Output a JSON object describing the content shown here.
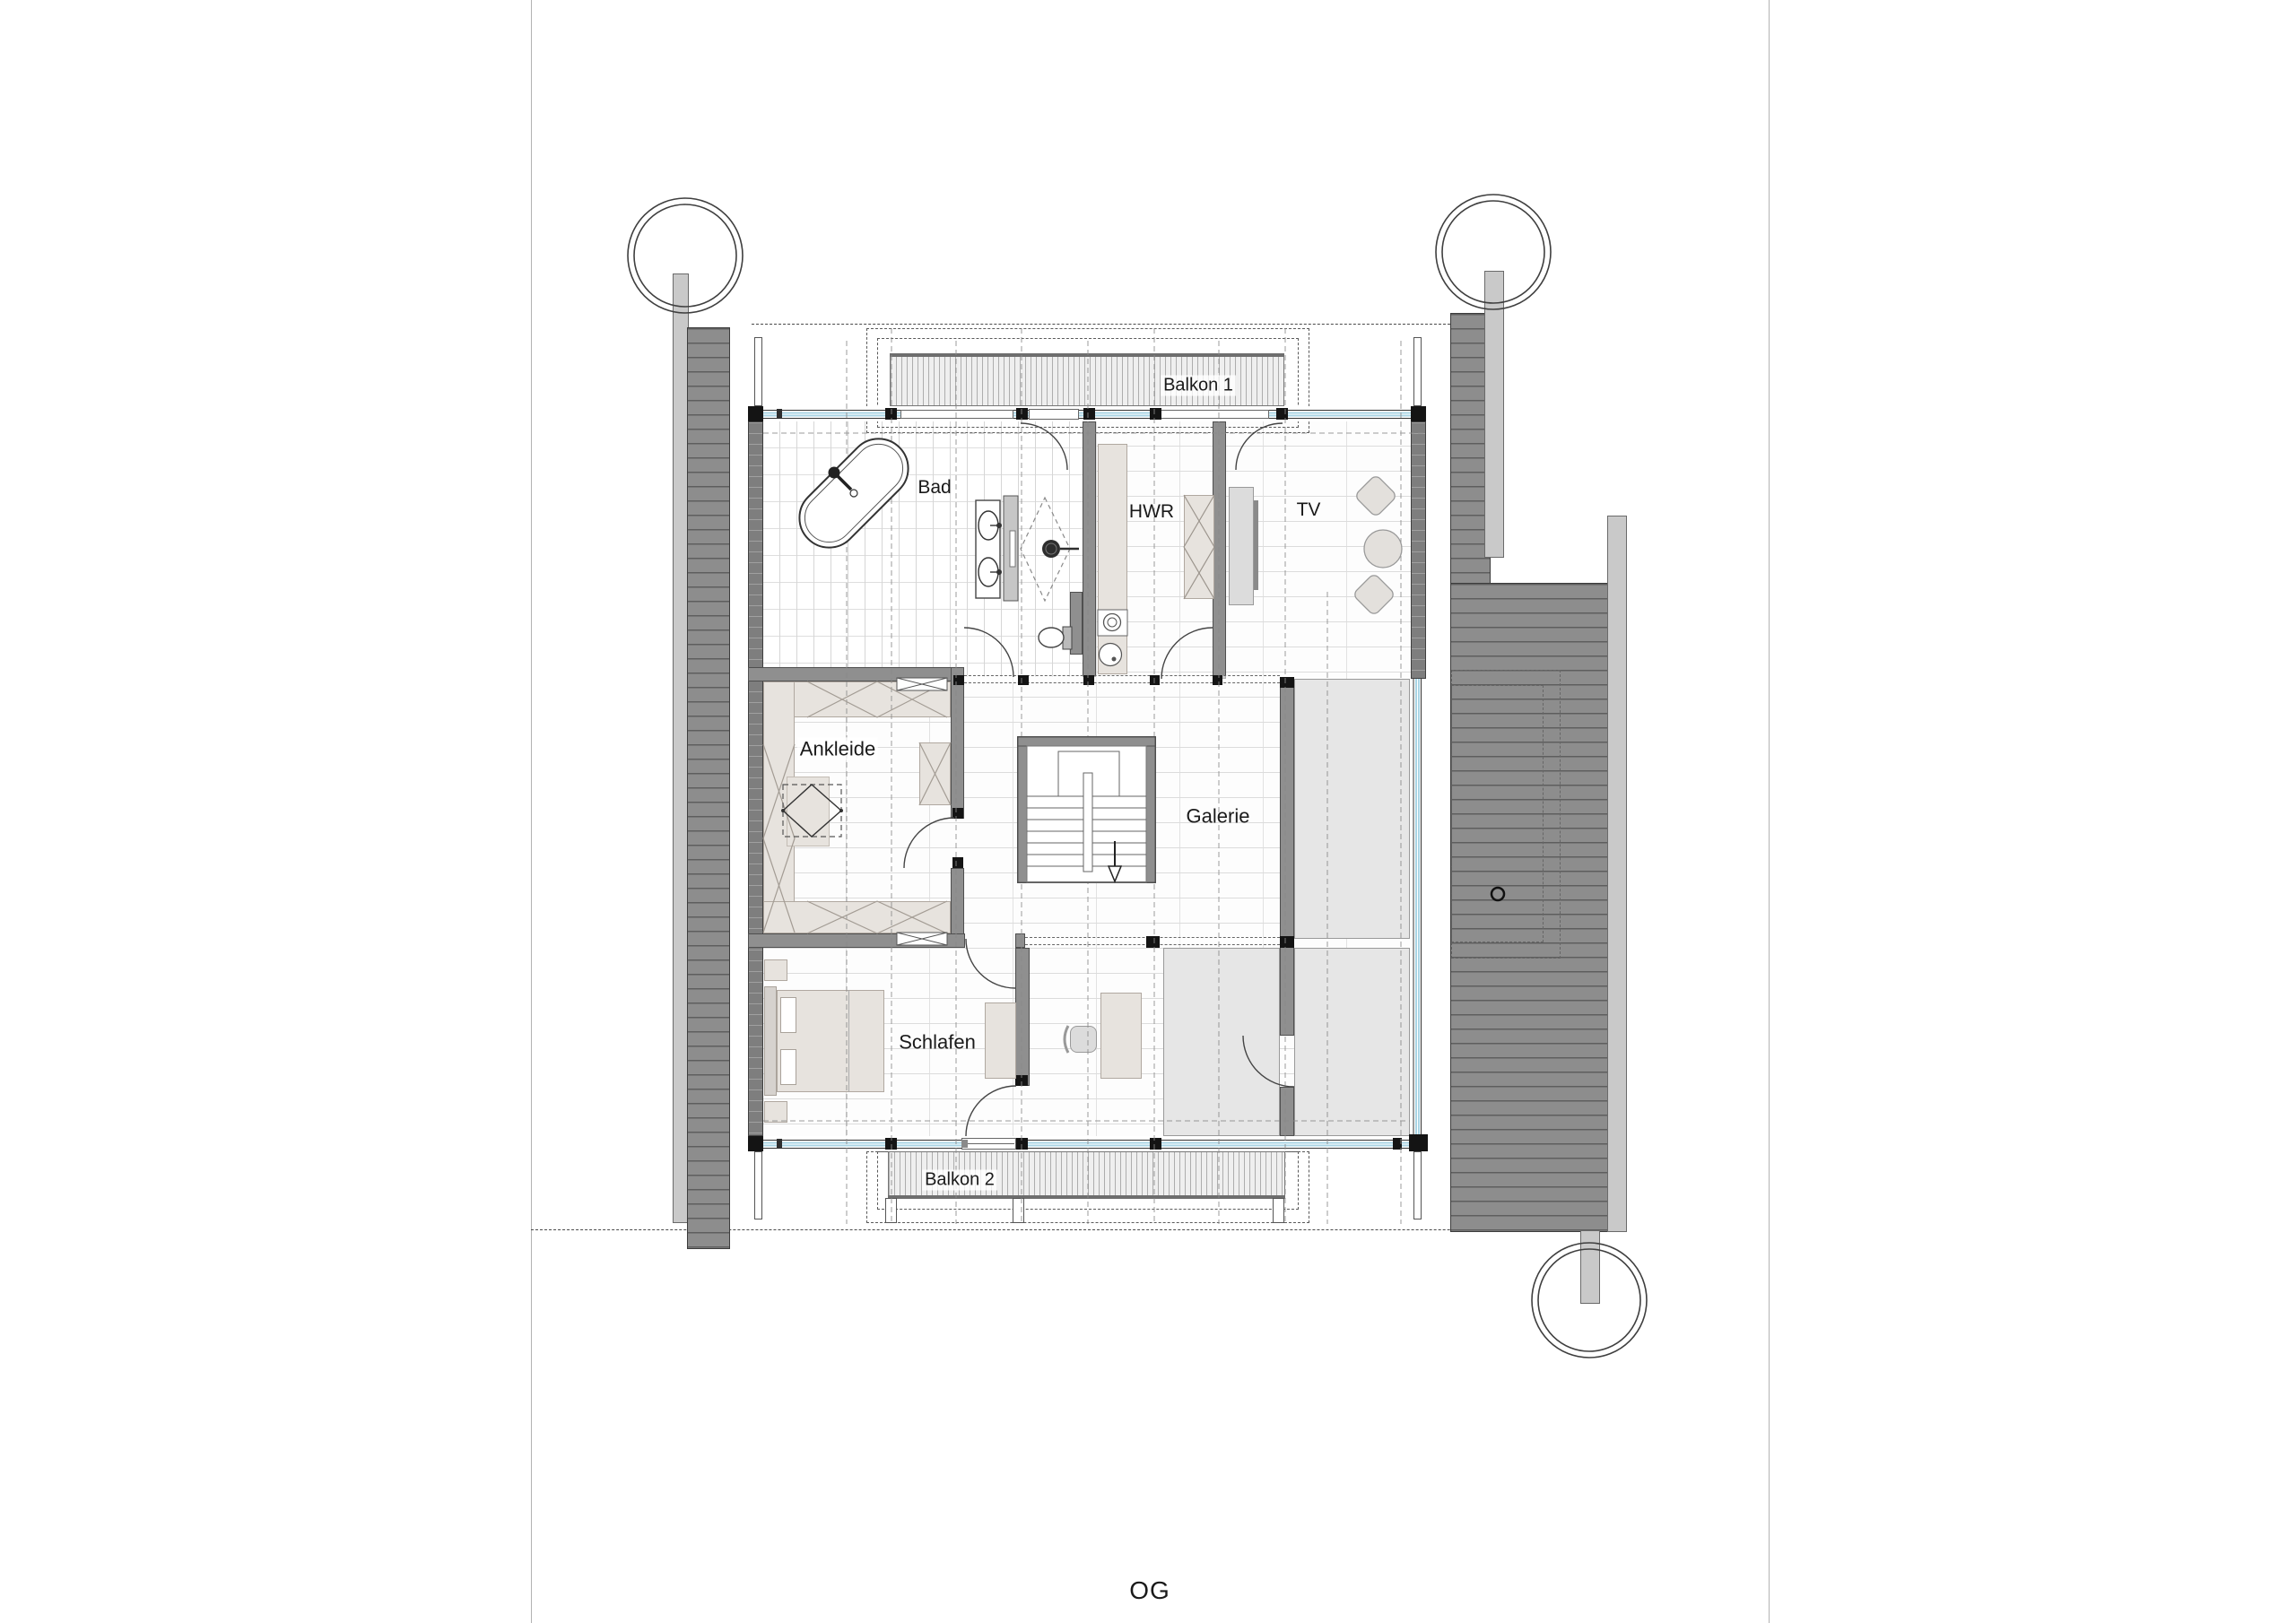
{
  "drawing": {
    "floor_label": "OG",
    "type_note": "architectural floor plan, upper floor"
  },
  "labels": {
    "balkon1": "Balkon 1",
    "bad": "Bad",
    "hwr": "HWR",
    "tv": "TV",
    "ankleide": "Ankleide",
    "galerie": "Galerie",
    "schlafen": "Schlafen",
    "balkon2": "Balkon 2"
  },
  "colors": {
    "glazing_accent": "#a9d4e4",
    "roof_hatch": "#8d8d8d",
    "wall_gray": "#8f8f8f",
    "void_gray": "#e6e6e6",
    "furniture_beige": "#e7e3de",
    "post_black": "#141414",
    "line_dark": "#444444"
  },
  "icons": {
    "tree_top_left": "tree-icon",
    "tree_top_right": "tree-icon",
    "tree_bottom_right": "tree-icon",
    "stair_down_arrow": "arrow-down-icon"
  }
}
